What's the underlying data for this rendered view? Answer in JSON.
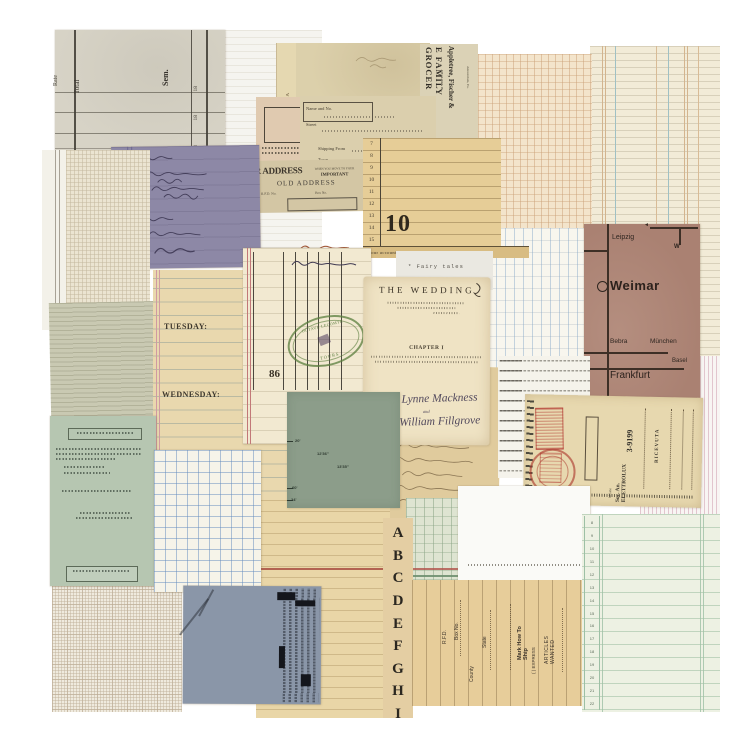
{
  "collage": {
    "gray_ledger": {
      "total": "Total",
      "sem": "Sem.",
      "rate": "Rate",
      "columns": [
        "18",
        "18",
        "18"
      ]
    },
    "soap_label": {
      "text": "SOAP CONTA"
    },
    "grocer_ad": {
      "line1": "E FAMILY GROCER",
      "line2": "DEALERS IN",
      "line3": "Appletree, Fischer &",
      "line4": "Amsterdam, Pa."
    },
    "address_form": {
      "row1": "Name and No.",
      "row2": "Street",
      "row3": "Shipping From",
      "row4": "Town",
      "row5": "Railroad"
    },
    "old_address_slip": {
      "big": "R ADDRESS",
      "when": "WHEN YOU MOVE TO YOUR",
      "important": "IMPORTANT",
      "old_address": "OLD ADDRESS",
      "rfd": "R.F.D. No.",
      "box": "Box No."
    },
    "numbered_ledger": {
      "rows": [
        "7",
        "8",
        "9",
        "10",
        "11",
        "12",
        "13",
        "14",
        "15"
      ],
      "big_number": "10",
      "footer": "Your account stated to date. If error"
    },
    "fairy_note": {
      "text": "* Fairy tales"
    },
    "planner": {
      "tuesday": "TUESDAY:",
      "wednesday": "WEDNESDAY:"
    },
    "stamp_ledger": {
      "stamp_top": "OCTAVE LECOMTE",
      "stamp_bottom": "TOURS",
      "page_number": "86"
    },
    "wedding_page": {
      "title": "THE WEDDING",
      "chapter": "CHAPTER I",
      "bride": "Kaye Lynne Mackness",
      "conjunction": "and",
      "groom": "Jesse William Fillgrove"
    },
    "map": {
      "leipzig": "Leipzig",
      "w": "W",
      "arrow": "◄",
      "weimar": "Weimar",
      "bebra": "Bebra",
      "muenchen": "München",
      "basel": "Basel",
      "frankfurt": "Frankfurt"
    },
    "receipt": {
      "title": "RICEVUTA",
      "number": "3-9199",
      "company": "Soc. An. ELETTROLUX",
      "city": "Milano"
    },
    "order_form": {
      "box_no": "Box No.",
      "rfd": "R.F.D.",
      "state": "State",
      "county": "County",
      "ship": "Mark How To Ship",
      "express": "( ) EXPRESS",
      "articles": "ARTICLES WANTED"
    },
    "alphabet_strip": {
      "letters": [
        "A",
        "B",
        "C",
        "D",
        "E",
        "F",
        "G",
        "H",
        "I"
      ]
    },
    "mint_ledger": {
      "rows": [
        "8",
        "9",
        "10",
        "11",
        "12",
        "13",
        "14",
        "15",
        "16",
        "17",
        "18",
        "19",
        "20",
        "21",
        "22"
      ]
    },
    "sage_plat": {
      "d1": "20'",
      "d2": "12'36\"",
      "d3": "13'35\"",
      "d4": "60'",
      "d5": "24'"
    }
  }
}
